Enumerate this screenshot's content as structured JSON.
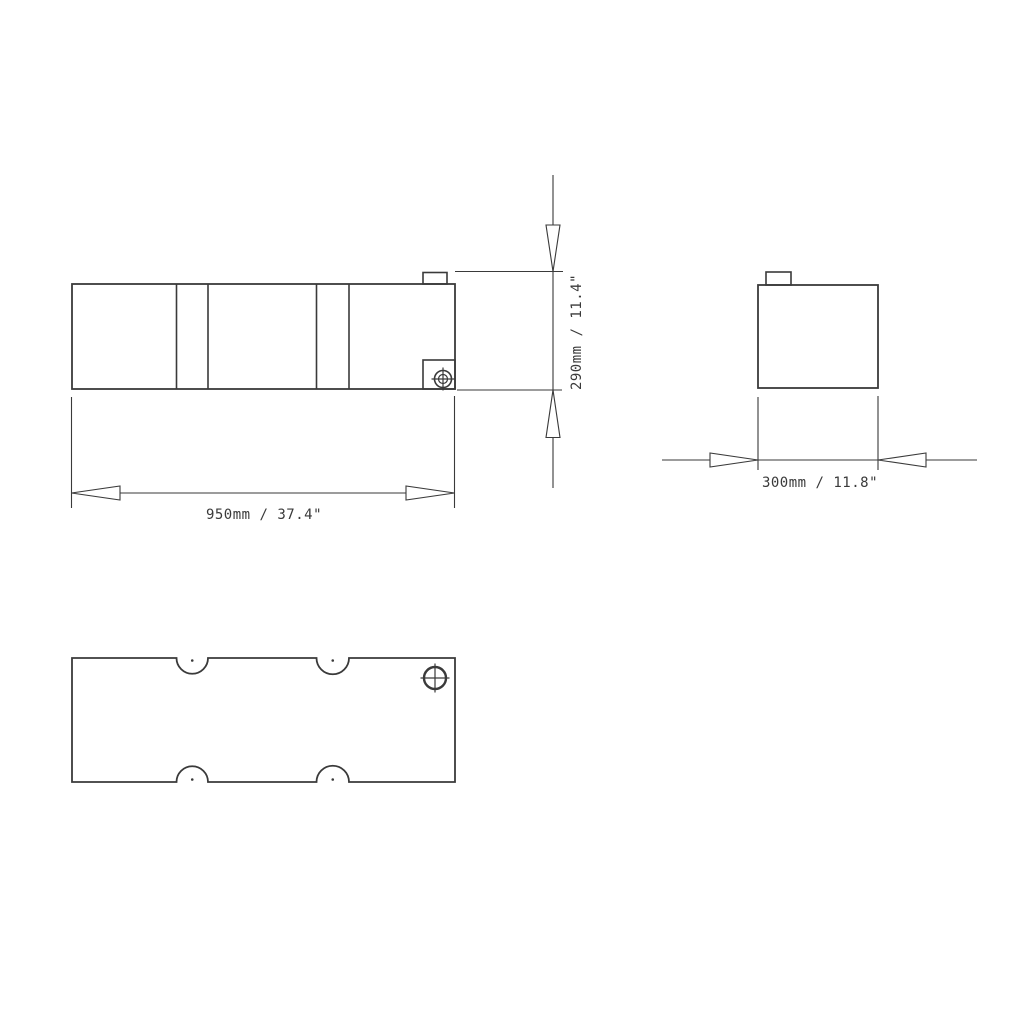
{
  "colors": {
    "background": "#ffffff",
    "line": "#3a3a3a",
    "text": "#3a3a3a"
  },
  "dimensions": {
    "length": {
      "label": "950mm / 37.4\"",
      "mm": 950,
      "inches": 37.4
    },
    "height": {
      "label": "290mm / 11.4\"",
      "mm": 290,
      "inches": 11.4
    },
    "width": {
      "label": "300mm / 11.8\"",
      "mm": 300,
      "inches": 11.8
    }
  }
}
